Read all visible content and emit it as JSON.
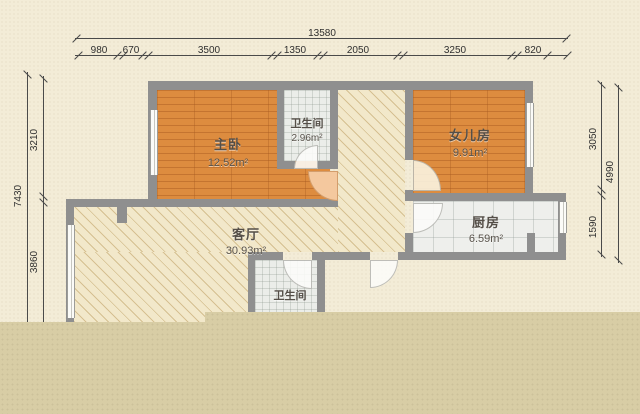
{
  "dims": {
    "top_total": "13580",
    "top_segments": [
      "980",
      "670",
      "3500",
      "1350",
      "2050",
      "3250",
      "820"
    ],
    "left_total": "7430",
    "left_segments": [
      "3210",
      "3860"
    ],
    "right_total": "4990",
    "right_segments": [
      "3050",
      "1590"
    ]
  },
  "rooms": {
    "master_bedroom": {
      "name": "主卧",
      "area": "12.52m²"
    },
    "bathroom_top": {
      "name": "卫生间",
      "area": "2.96m²"
    },
    "daughter_room": {
      "name": "女儿房",
      "area": "9.91m²"
    },
    "kitchen": {
      "name": "厨房",
      "area": "6.59m²"
    },
    "living_room": {
      "name": "客厅",
      "area": "30.93m²"
    },
    "bathroom_bottom": {
      "name": "卫生间"
    }
  },
  "colors": {
    "paper": "#f3ecd7",
    "cropped_band": "#d8cda5",
    "wall": "#8f8f8f",
    "wood_floor": "#dd8c3f",
    "tile_floor": "#ebede9",
    "hatch_floor": "#f2e8ca"
  }
}
